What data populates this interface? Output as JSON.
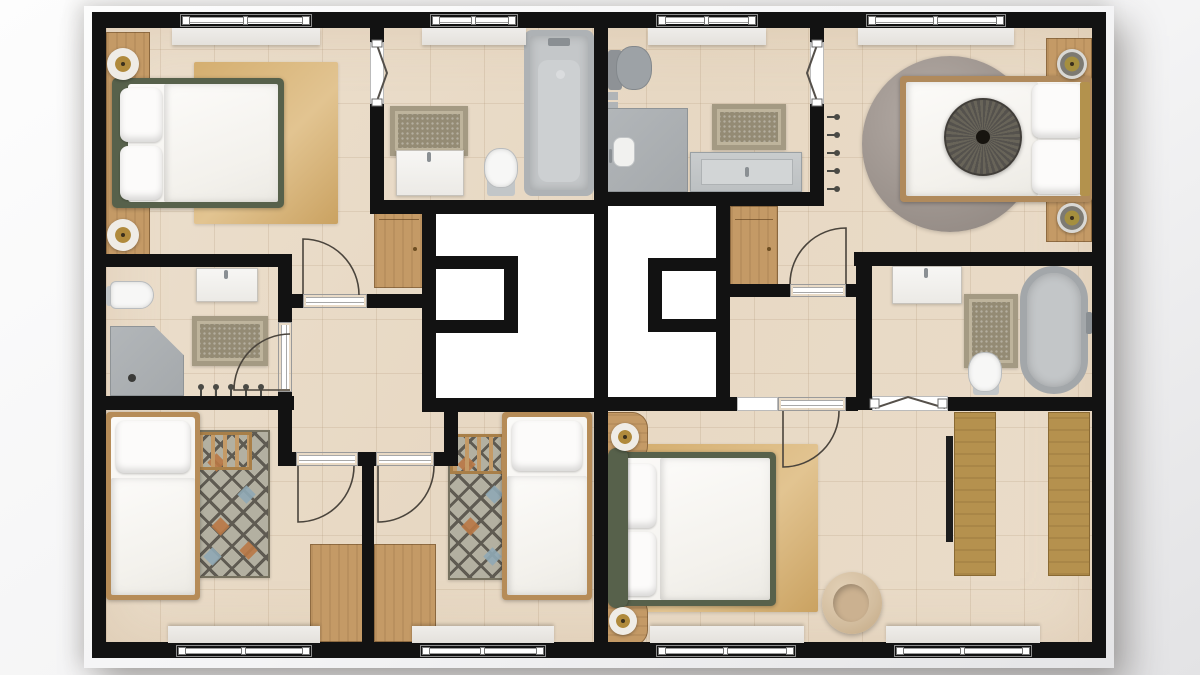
{
  "title": "Upper-floor architectural plan — two mirrored residential units",
  "plan_type": "floor-plan",
  "colors": {
    "wall": "#121212",
    "void": "#ffffff",
    "wood": "#c49a66",
    "wardrobe": "#b5914e",
    "green": "#57614b",
    "bathrug": "#a49a83",
    "bathrug_inner": "#948b74",
    "dia_base": "#b3b0a1",
    "dia_line": "#5f5b52",
    "dia_orange": "#b97845",
    "dia_blue": "#8fa8b5",
    "lamp_gold": "#b08a3c",
    "arc": "#4a443c"
  },
  "counts": {
    "bedrooms": 5,
    "bathrooms": 4,
    "stair_voids": 2,
    "windows": 8,
    "door_arcs": 6,
    "folding_doors": 3,
    "sliding_doors": 1
  },
  "rooms": [
    {
      "name": "Bedroom — top left: double bed with green frame, wood headboard wall, two lamps, tan rug"
    },
    {
      "name": "Bathroom — top left unit: bathtub, vanity, toilet, bath rug, folding door"
    },
    {
      "name": "Bathroom — mid left unit: corner shower, toilet, vanity, bath rug, towel radiator, sliding door"
    },
    {
      "name": "Bedroom — bottom left: single bed, diamond rug, wooden ladder, desk"
    },
    {
      "name": "Bedroom — bottom middle: single bed, diamond rug, wooden ladder, desk"
    },
    {
      "name": "Hallway — left unit with dresser"
    },
    {
      "name": "Stair void — left unit"
    },
    {
      "name": "Bedroom — top right: double bed, round gray rug, round throw, wood headboard wall, towel radiator"
    },
    {
      "name": "Bathroom — top right unit: walk-in shower, gray toilet, gray vanity, bath rug, folding door"
    },
    {
      "name": "Bathroom — mid right unit (ensuite): freestanding oval tub, vanity, toilet, bath rug, folding door"
    },
    {
      "name": "Hallway — right unit with dresser"
    },
    {
      "name": "Stair void — right unit"
    },
    {
      "name": "Master bedroom — bottom right: double bed with green frame, nightstands with lamps, tan rug, armchair"
    },
    {
      "name": "Dressing area — two wardrobe runs"
    }
  ],
  "furniture": [
    "double-bed",
    "single-bed",
    "pillow",
    "duvet",
    "nightstand",
    "lamp",
    "dresser",
    "desk",
    "wardrobe",
    "armchair",
    "bathtub",
    "freestanding-oval-tub",
    "corner-shower",
    "walk-in-shower",
    "toilet",
    "vanity-sink",
    "tan-rug",
    "round-gray-rug",
    "bath-rug",
    "diamond-rug",
    "wooden-ladder",
    "round-throw",
    "towel-radiator"
  ]
}
